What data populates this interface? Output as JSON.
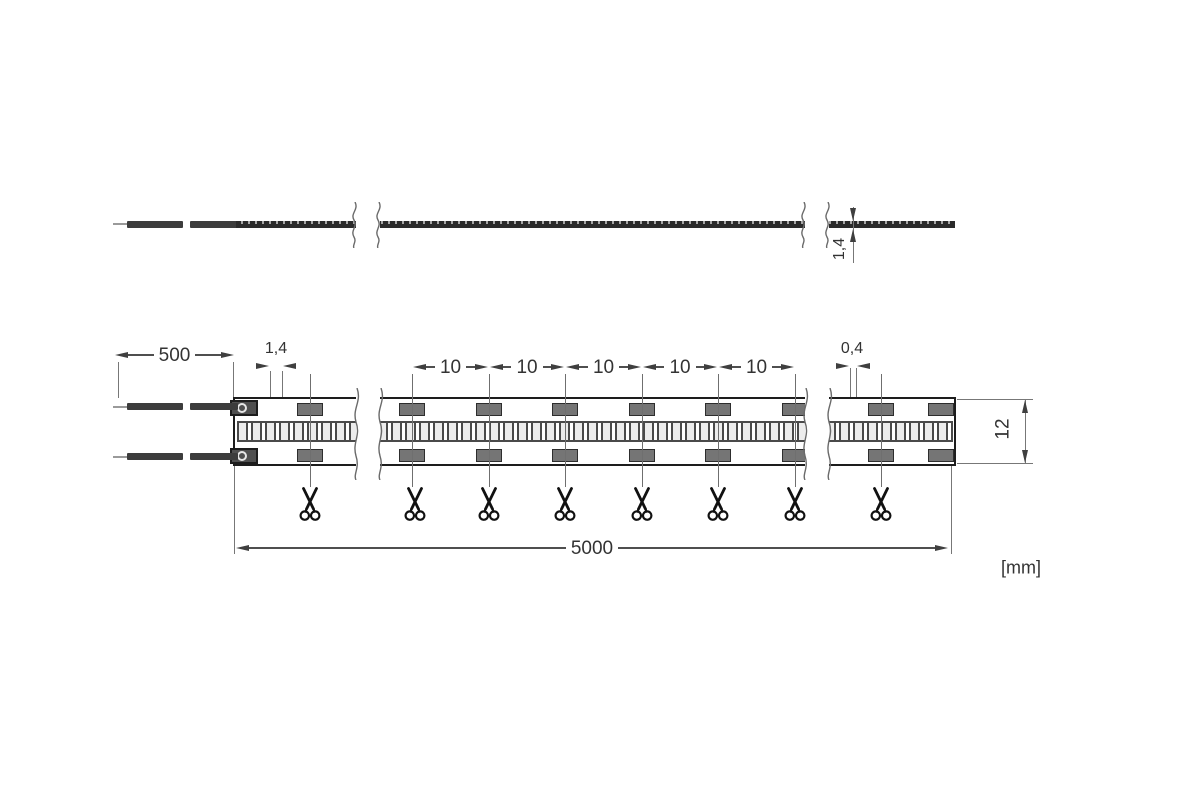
{
  "drawing_type": "LED flex strip dimensional drawing",
  "unit_note": "[mm]",
  "side_view": {
    "thickness": "1,4"
  },
  "plan_view": {
    "lead_length": "500",
    "led_width": "1,4",
    "cut_segments": [
      "10",
      "10",
      "10",
      "10",
      "10"
    ],
    "led_gap": "0,4",
    "total_length": "5000",
    "strip_width": "12"
  },
  "icons": {
    "scissors": "cut-mark-scissors",
    "break_mark": "drawing-break-squiggle"
  },
  "colors": {
    "line": "#4f4f4f",
    "strip_outline": "#1d1d1d",
    "pad_fill": "#757575",
    "wire": "#3c3c3c",
    "led_cell_fill": "#ececec",
    "background": "#ffffff"
  }
}
